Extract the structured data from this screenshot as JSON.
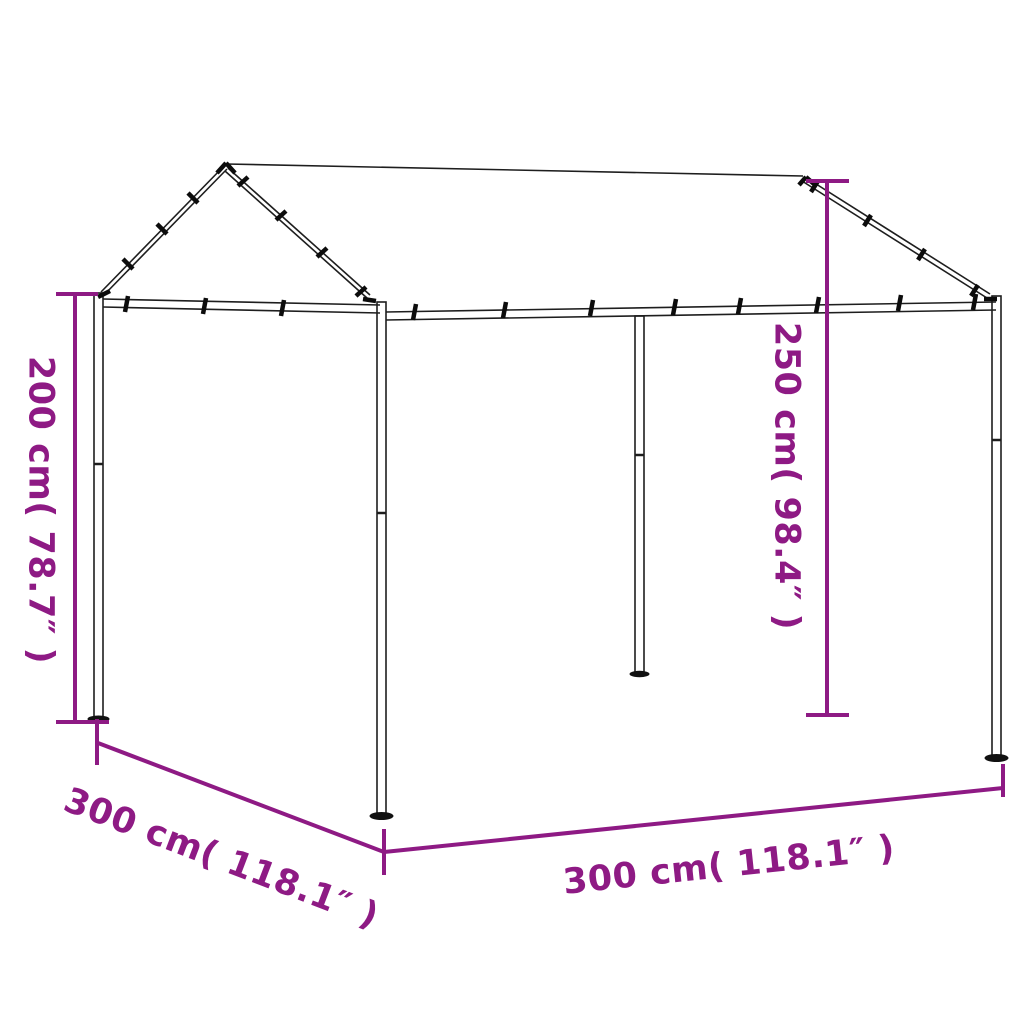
{
  "page": {
    "background_color": "#ffffff"
  },
  "diagram": {
    "type": "product-dimension-drawing",
    "subject": "steel canopy tent frame with fabric gable roof",
    "accent_color": "#8E1A84",
    "line_color": "#1e1e1e",
    "dimensions": {
      "height_left": "200 cm( 78.7″ )",
      "height_right": "250 cm( 98.4″ )",
      "width_front": "300 cm( 118.1″ )",
      "depth_left": "300 cm( 118.1″ )"
    }
  }
}
